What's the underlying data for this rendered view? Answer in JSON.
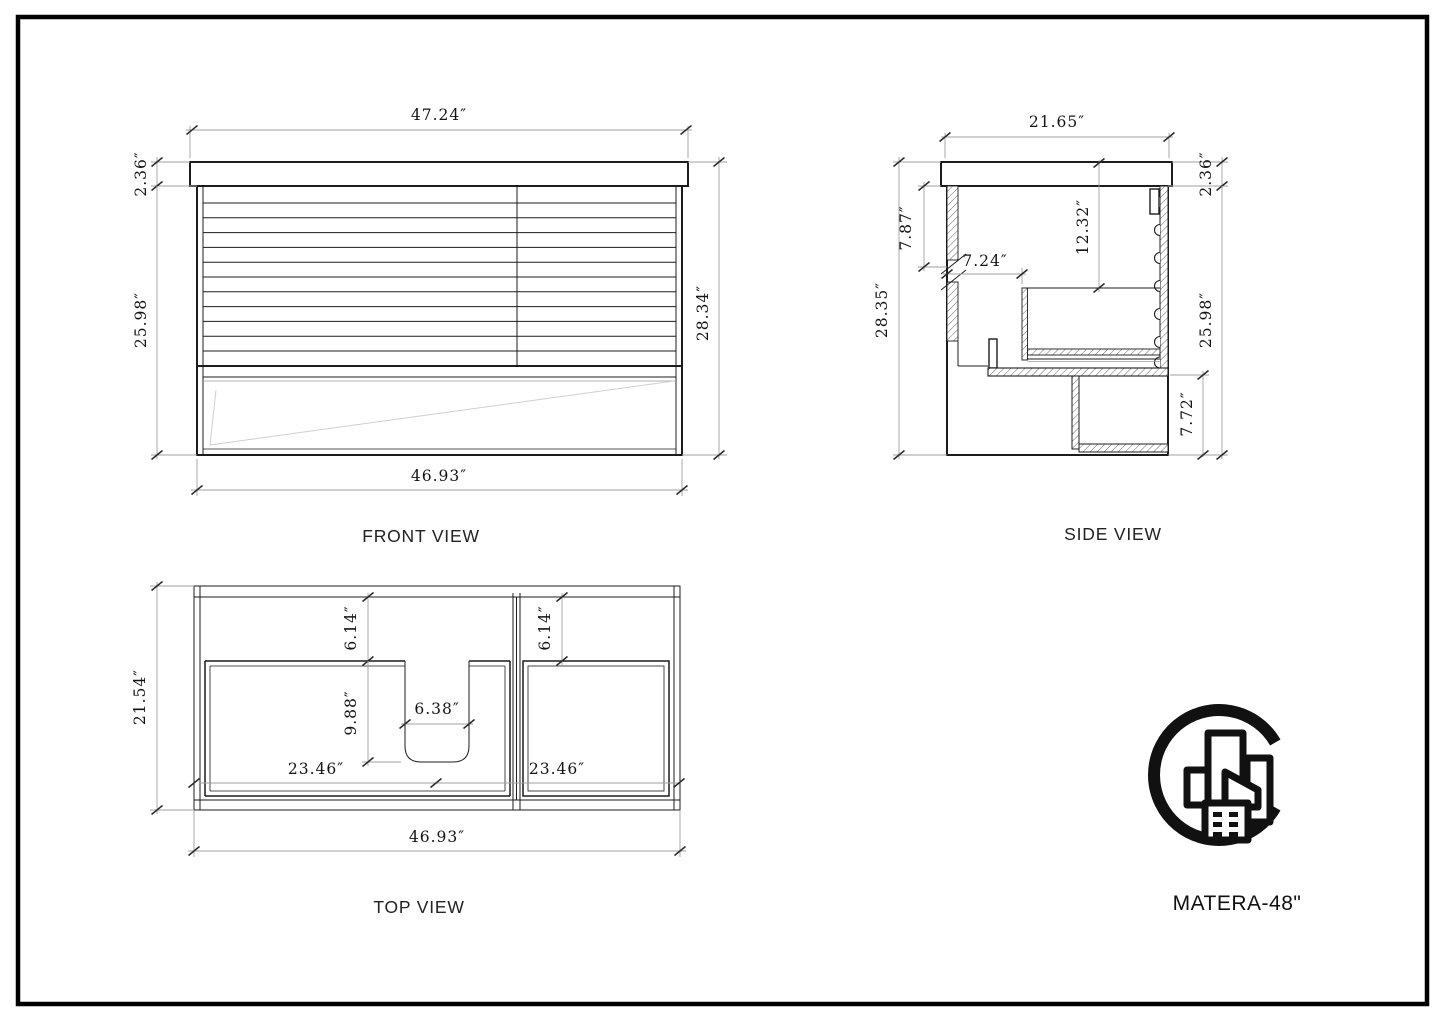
{
  "page": {
    "product_label": "MATERA-48\"",
    "logo": "city-c-logo"
  },
  "views": {
    "front": {
      "label": "FRONT VIEW",
      "dims": {
        "top_width": "47.24″",
        "counter_height": "2.36″",
        "body_height": "25.98″",
        "total_height": "28.34″",
        "bottom_width": "46.93″"
      }
    },
    "side": {
      "label": "SIDE VIEW",
      "dims": {
        "top_depth": "21.65″",
        "total_height": "28.35″",
        "upper_inner_height": "7.87″",
        "wall_inset": "7.24″",
        "drawer_drop": "12.32″",
        "counter_height": "2.36″",
        "body_height": "25.98″",
        "shelf_height": "7.72″"
      }
    },
    "top": {
      "label": "TOP VIEW",
      "dims": {
        "depth": "21.54″",
        "left_inset": "6.14″",
        "right_inset": "6.14″",
        "sink_depth": "9.88″",
        "sink_width": "6.38″",
        "left_door_width": "23.46″",
        "right_door_width": "23.46″",
        "bottom_width": "46.93″"
      }
    }
  }
}
